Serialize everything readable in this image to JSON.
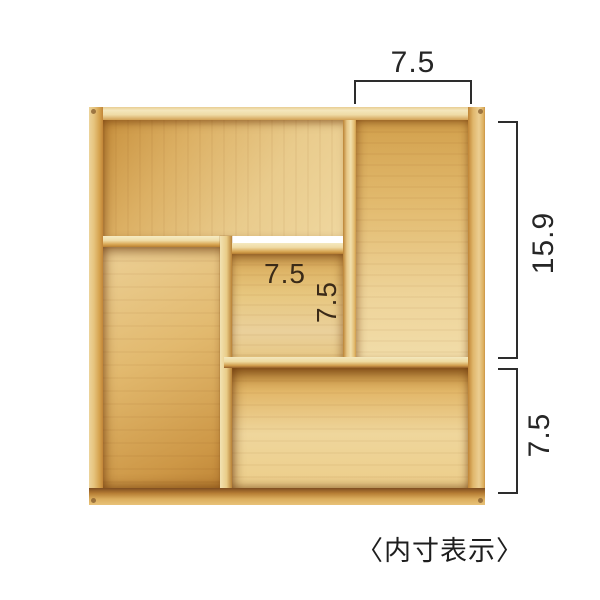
{
  "caption": "〈内寸表示〉",
  "dimensions": {
    "top_width": "7.5",
    "right_height": "15.9",
    "right_lower_height": "7.5",
    "inner_width": "7.5",
    "inner_depth": "7.5"
  },
  "product": {
    "type": "wooden-organizer-tray",
    "compartments": [
      "top-left-wide",
      "top-right-tall",
      "left-tall",
      "center-square",
      "bottom-wide"
    ]
  },
  "colors": {
    "background": "#ffffff",
    "dimension_line": "#2d2d2d",
    "dimension_text": "#262626",
    "wood_light": "#f1dca8",
    "wood_mid": "#e0b569",
    "wood_gold": "#d2a04c",
    "wood_dark": "#b57c33",
    "wood_shadow": "#7e4c20"
  }
}
